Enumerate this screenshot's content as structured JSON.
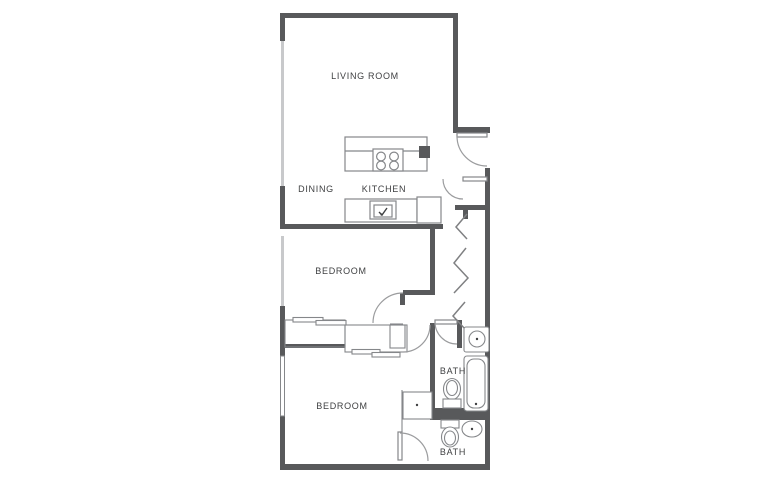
{
  "title": "Apartment Floor Plan",
  "colors": {
    "wall": "#58595b",
    "line": "#85878a",
    "line_light": "#9b9c9e",
    "window": "#c8c9cb",
    "text": "#3f4042",
    "background": "#ffffff"
  },
  "rooms": [
    {
      "name": "living-room",
      "label": "LIVING ROOM"
    },
    {
      "name": "dining",
      "label": "DINING"
    },
    {
      "name": "kitchen",
      "label": "KITCHEN"
    },
    {
      "name": "bedroom-1",
      "label": "BEDROOM"
    },
    {
      "name": "bedroom-2",
      "label": "BEDROOM"
    },
    {
      "name": "bath-1",
      "label": "BATH"
    },
    {
      "name": "bath-2",
      "label": "BATH"
    }
  ],
  "fixtures": [
    "kitchen-island",
    "stove",
    "kitchen-sink",
    "refrigerator",
    "sliding-closet-doors",
    "bifold-closet-doors",
    "toilet",
    "bathtub",
    "vanity-sink",
    "cabinet",
    "entry-door",
    "interior-doors",
    "windows"
  ]
}
